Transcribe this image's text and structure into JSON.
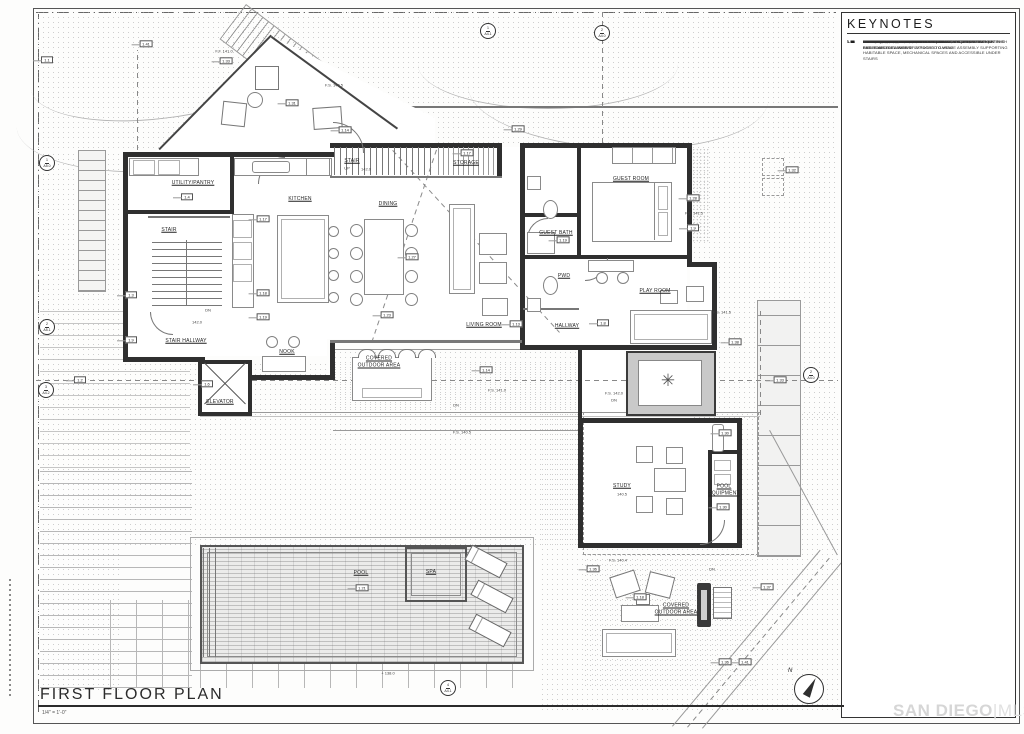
{
  "sheet": {
    "title": "FIRST FLOOR PLAN",
    "scale": "1/4\" = 1'-0\"",
    "watermark_left": "SAN DIEGO",
    "watermark_divider": "|",
    "watermark_right": "MLS",
    "north_label": "N"
  },
  "colors": {
    "paper": "#fdfdfc",
    "wall_ink": "#2f2f2f",
    "thin_line": "#8a8a8a",
    "label_ink": "#1f1f1f",
    "watermark": "#d6d6d6"
  },
  "keynotes": {
    "header": "KEYNOTES",
    "items": [
      {
        "num": "1.1",
        "text": "PROPERTY LINE, TYP."
      },
      {
        "num": "1.2",
        "text": "SETBACK LINE, TYP."
      },
      {
        "num": "1.3",
        "text": "EXTERIOR WALL, 2x WOOD STUD FRAMING, EXTERIOR FINISH PER EXTERIOR ELEVATIONS"
      },
      {
        "num": "1.4",
        "text": "INTERIOR WALL, 2x WOOD STUD FRAMING"
      },
      {
        "num": "1.5",
        "text": "RETAINING WALL, GYP FINISH AT INTERIOR SPACES, EXTERIOR FINISH PER SOILS ENG. WHERE EXPOSED TO VIEW"
      },
      {
        "num": "1.6",
        "text": "ELEVATOR, RECESSED SLAB"
      },
      {
        "num": "1.8",
        "text": "DOOR, TYP."
      },
      {
        "num": "1.9",
        "text": "WINDOW, TYP."
      },
      {
        "num": "1.10",
        "text": "GUARDRAIL, PER SITE PLAN"
      },
      {
        "num": "1.12",
        "text": "PROVIDE 5/8\" TYPE 'X' GYP. BOARD (1-HOUR CONSTRUCTION) AT THE WALLS AND CEILINGS OF ATTACHED GARAGE ASSEMBLY SUPPORTING HABITABLE SPACE, MECHANICAL SPACES AND ACCESSIBLE UNDER STAIRS"
      },
      {
        "num": "1.13",
        "text": "PLASTER, PER SITE PLAN"
      },
      {
        "num": "1.14",
        "text": "LINE OF BUILDING ABOVE"
      },
      {
        "num": "1.17",
        "text": "BUILT-IN CABINETS"
      },
      {
        "num": "1.18",
        "text": "APPLIANCE, PER OWNER"
      },
      {
        "num": "1.19",
        "text": "PLUMBING FIXTURE, PER OWNER"
      },
      {
        "num": "1.20",
        "text": "WALK-IN SHOWER WITH RECESSED SLAB OR FLOOR FRAMING"
      },
      {
        "num": "1.21",
        "text": "POOL, UNDER SEPARATE PERMIT"
      },
      {
        "num": "1.22",
        "text": "LIFT AND SLIDING DOOR"
      },
      {
        "num": "1.23",
        "text": "FIREPLACE"
      },
      {
        "num": "1.26",
        "text": "LINE OF BUILDING BELOW"
      },
      {
        "num": "1.27",
        "text": "LINE OF SOFFIT/CEILING/BEAM ABOVE"
      },
      {
        "num": "1.28",
        "text": "42\" HIGH GLASS GUARDRAIL"
      },
      {
        "num": "1.29",
        "text": "LINE OF OVERHANG ABOVE"
      },
      {
        "num": "1.30",
        "text": "POOL EQUIPMENT LOCATION"
      },
      {
        "num": "1.31",
        "text": "WALL SCONCE"
      },
      {
        "num": "1.32",
        "text": "AC UNITS LOCATION WITH SCREENWALL AS REQUIRED"
      },
      {
        "num": "1.33",
        "text": "PROPOSED CONCRETE SITE STAIRS ON GRADE, PER SITE PLAN"
      },
      {
        "num": "1.34",
        "text": "DECK ABOVE GARAGE, FINISH PER LANDSCAPE DRAWINGS"
      },
      {
        "num": "1.36",
        "text": "HARDSCAPE, PER SITE PLAN"
      },
      {
        "num": "1.37",
        "text": "OVERHANG ENCROACHMENT"
      },
      {
        "num": "1.38",
        "text": "EXTERIOR 42\" HIGH SOLID GUARDRAIL"
      },
      {
        "num": "1.41",
        "text": "EXISTING TOPOGRAPHY, PER SITE PLAN"
      },
      {
        "num": "1.43",
        "text": "PROPOSED TOPOGRAPHY, PER SITE PLAN"
      }
    ]
  },
  "plan": {
    "rooms": [
      {
        "label": "UTILITY/PANTRY",
        "x": 193,
        "y": 183
      },
      {
        "label": "KITCHEN",
        "x": 300,
        "y": 199
      },
      {
        "label": "STAIR",
        "x": 169,
        "y": 230
      },
      {
        "label": "STAIR",
        "x": 352,
        "y": 161
      },
      {
        "label": "STORAGE",
        "x": 466,
        "y": 163
      },
      {
        "label": "DINING",
        "x": 388,
        "y": 204
      },
      {
        "label": "GUEST ROOM",
        "x": 631,
        "y": 179
      },
      {
        "label": "GUEST BATH",
        "x": 556,
        "y": 233
      },
      {
        "label": "PWD",
        "x": 564,
        "y": 276
      },
      {
        "label": "PLAY ROOM",
        "x": 655,
        "y": 291
      },
      {
        "label": "LIVING ROOM",
        "x": 484,
        "y": 325
      },
      {
        "label": "HALLWAY",
        "x": 567,
        "y": 326
      },
      {
        "label": "STAIR HALLWAY",
        "x": 186,
        "y": 341
      },
      {
        "label": "NOOK",
        "x": 287,
        "y": 352
      },
      {
        "label": "ELEVATOR",
        "x": 220,
        "y": 402
      },
      {
        "label": "COVERED OUTDOOR AREA",
        "x": 379,
        "y": 362,
        "w": 52
      },
      {
        "label": "STUDY",
        "x": 622,
        "y": 486
      },
      {
        "label": "POOL EQUIPMENT",
        "x": 724,
        "y": 490,
        "w": 34
      },
      {
        "label": "POOL",
        "x": 361,
        "y": 573
      },
      {
        "label": "SPA",
        "x": 431,
        "y": 572
      },
      {
        "label": "COVERED OUTDOOR AREA",
        "x": 676,
        "y": 609,
        "w": 52
      }
    ],
    "levels": [
      {
        "text": "F.F. 141.0",
        "x": 224,
        "y": 51
      },
      {
        "text": "F.S. 140.5",
        "x": 334,
        "y": 85
      },
      {
        "text": "UP",
        "x": 347,
        "y": 168
      },
      {
        "text": "142.0",
        "x": 366,
        "y": 169
      },
      {
        "text": "DN",
        "x": 208,
        "y": 310
      },
      {
        "text": "142.0",
        "x": 197,
        "y": 322
      },
      {
        "text": "F.S. 141.5",
        "x": 694,
        "y": 213
      },
      {
        "text": "F.S. 141.5",
        "x": 722,
        "y": 312
      },
      {
        "text": "F.S. 141.0",
        "x": 497,
        "y": 390
      },
      {
        "text": "DN",
        "x": 456,
        "y": 405
      },
      {
        "text": "F.S. 142.0",
        "x": 614,
        "y": 393
      },
      {
        "text": "DN",
        "x": 614,
        "y": 400
      },
      {
        "text": "F.S. 140.5",
        "x": 462,
        "y": 432
      },
      {
        "text": "140.5",
        "x": 622,
        "y": 494
      },
      {
        "text": "F.S. 140.4",
        "x": 618,
        "y": 560
      },
      {
        "text": "DN",
        "x": 712,
        "y": 569
      },
      {
        "text": "+ 138.0",
        "x": 388,
        "y": 673
      }
    ],
    "tags": [
      {
        "label": "1.41",
        "x": 146,
        "y": 44
      },
      {
        "label": "1.1",
        "x": 47,
        "y": 60
      },
      {
        "label": "1.33",
        "x": 226,
        "y": 61
      },
      {
        "label": "1.31",
        "x": 292,
        "y": 103
      },
      {
        "label": "1.14",
        "x": 345,
        "y": 130
      },
      {
        "label": "1.29",
        "x": 518,
        "y": 129
      },
      {
        "label": "1.17",
        "x": 467,
        "y": 153
      },
      {
        "label": "1.4",
        "x": 187,
        "y": 197
      },
      {
        "label": "1.32",
        "x": 792,
        "y": 170
      },
      {
        "label": "1.3",
        "x": 131,
        "y": 295
      },
      {
        "label": "1.9",
        "x": 131,
        "y": 340
      },
      {
        "label": "1.17",
        "x": 263,
        "y": 219
      },
      {
        "label": "1.18",
        "x": 263,
        "y": 293
      },
      {
        "label": "1.19",
        "x": 263,
        "y": 317
      },
      {
        "label": "1.6",
        "x": 207,
        "y": 384
      },
      {
        "label": "1.27",
        "x": 412,
        "y": 257
      },
      {
        "label": "1.23",
        "x": 387,
        "y": 315
      },
      {
        "label": "1.13",
        "x": 516,
        "y": 324
      },
      {
        "label": "1.8",
        "x": 603,
        "y": 323
      },
      {
        "label": "1.19",
        "x": 563,
        "y": 240
      },
      {
        "label": "1.28",
        "x": 693,
        "y": 198
      },
      {
        "label": "1.9",
        "x": 693,
        "y": 228
      },
      {
        "label": "1.38",
        "x": 735,
        "y": 342
      },
      {
        "label": "1.14",
        "x": 486,
        "y": 370
      },
      {
        "label": "1.2",
        "x": 80,
        "y": 380
      },
      {
        "label": "1.33",
        "x": 780,
        "y": 380
      },
      {
        "label": "1.30",
        "x": 725,
        "y": 433
      },
      {
        "label": "1.30",
        "x": 723,
        "y": 507
      },
      {
        "label": "1.36",
        "x": 593,
        "y": 569
      },
      {
        "label": "1.18",
        "x": 640,
        "y": 597
      },
      {
        "label": "1.37",
        "x": 767,
        "y": 587
      },
      {
        "label": "1.21",
        "x": 362,
        "y": 588
      },
      {
        "label": "1.36",
        "x": 725,
        "y": 662
      },
      {
        "label": "1.41",
        "x": 745,
        "y": 662
      }
    ],
    "markers": [
      {
        "num": "1",
        "sheet": "A5.0",
        "x": 47,
        "y": 163
      },
      {
        "num": "2",
        "sheet": "A5.1",
        "x": 47,
        "y": 327
      },
      {
        "num": "3",
        "sheet": "A4.2",
        "x": 46,
        "y": 390
      },
      {
        "num": "1",
        "sheet": "A4.1",
        "x": 488,
        "y": 31
      },
      {
        "num": "2",
        "sheet": "A4.0",
        "x": 602,
        "y": 33
      },
      {
        "num": "2",
        "sheet": "A4.0",
        "x": 811,
        "y": 375
      },
      {
        "num": "4",
        "sheet": "A4.1",
        "x": 448,
        "y": 688
      }
    ]
  }
}
